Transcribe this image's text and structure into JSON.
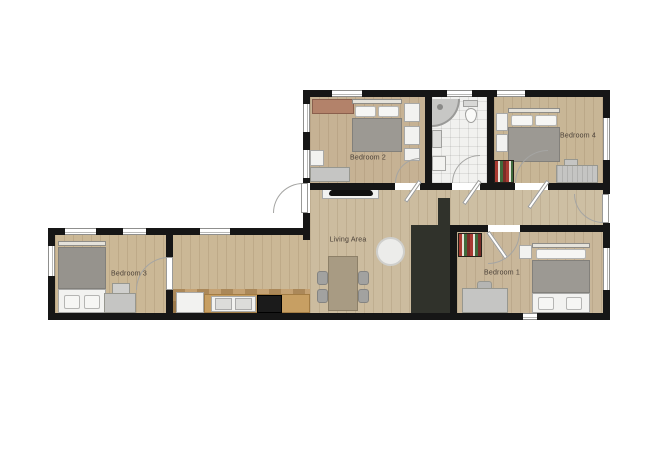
{
  "plan": {
    "type": "apartment floor plan",
    "labels": {
      "bedroom1": "Bedroom 1",
      "bedroom2": "Bedroom 2",
      "bedroom3": "Bedroom 3",
      "bedroom4": "Bedroom 4",
      "living_area": "Living Area"
    },
    "colors": {
      "background": "#ffffff",
      "wall": "#161616",
      "wood_floor": "#c9b89b",
      "bathroom_tile": "#f1f1ef",
      "kitchen_tile": "#b98f57",
      "sofa": "#30322b",
      "bed_blanket": "#9c9993",
      "bookshelf_red": "#a83a32",
      "bookshelf_green": "#3f6b3c",
      "label_text": "#4a4038"
    }
  }
}
